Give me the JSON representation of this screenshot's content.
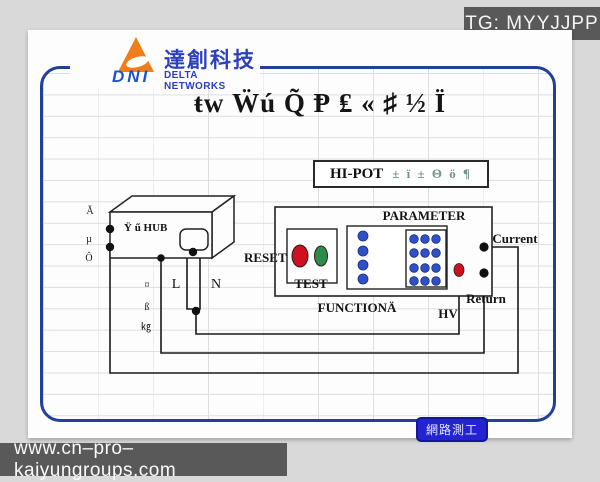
{
  "header": {
    "tag": "TG: MYYJJPP"
  },
  "logo": {
    "dni": "DNI",
    "cjk": "達創科技",
    "en": "DELTA NETWORKS"
  },
  "title": "ŧw Ẅú Q̃ Ᵽ ₤ « ♯ ½ Ï",
  "hipot": {
    "label": "HI-POT",
    "garbled": "± ï ± Θ ö ¶"
  },
  "diagram": {
    "hub_label": "Ÿ ű HUB",
    "left_col": [
      "Ă",
      "µ",
      "Ô"
    ],
    "mid_col": [
      "¤",
      "ß",
      "㎏"
    ],
    "line_l": "L",
    "line_n": "N",
    "reset": "RESET",
    "test": "TEST",
    "parameter": "PARAMETER",
    "function": "FUNCTIONÄ",
    "hv": "HV",
    "current": "Current",
    "return": "Return"
  },
  "footer": {
    "badge": "網路測工",
    "url": "www.cn–pro–kaiyungroups.com"
  },
  "colors": {
    "border_blue": "#21409a",
    "badge_blue": "#2323cf",
    "bar_gray": "#595959",
    "logo_orange": "#ef7d1a",
    "logo_blue": "#2b3fc0",
    "wire_black": "#1a1a1a",
    "button_red": "#cf1020",
    "button_green": "#2e8b4a",
    "dot_blue": "#3050c8",
    "garbled_teal": "#6f938d"
  }
}
